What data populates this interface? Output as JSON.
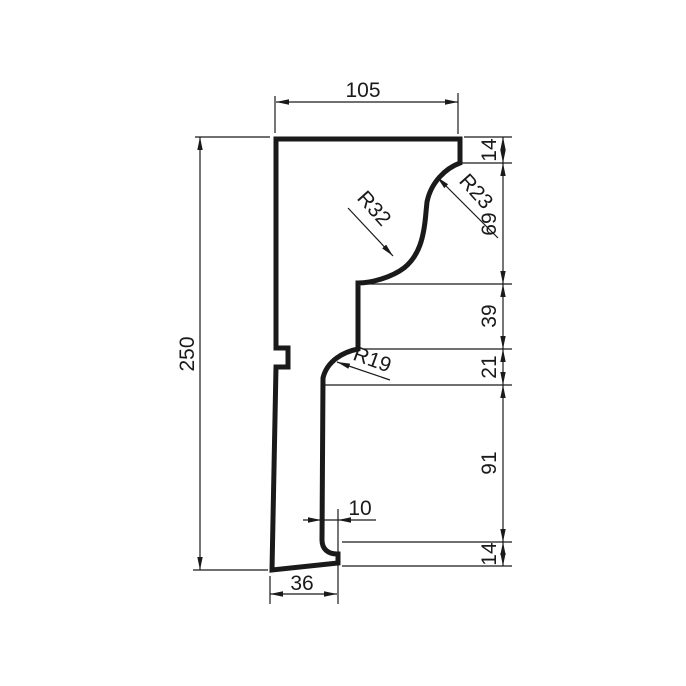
{
  "drawing": {
    "kind": "moulding-profile-section",
    "line_color": "#1a1a1a",
    "background_color": "#ffffff",
    "dims": {
      "top_width": "105",
      "total_height": "250",
      "right_chain": [
        "14",
        "69",
        "39",
        "21",
        "91",
        "14"
      ],
      "step_width": "10",
      "bottom_width": "36"
    },
    "radii": {
      "top": "R23",
      "middle": "R32",
      "lower": "R19"
    }
  }
}
